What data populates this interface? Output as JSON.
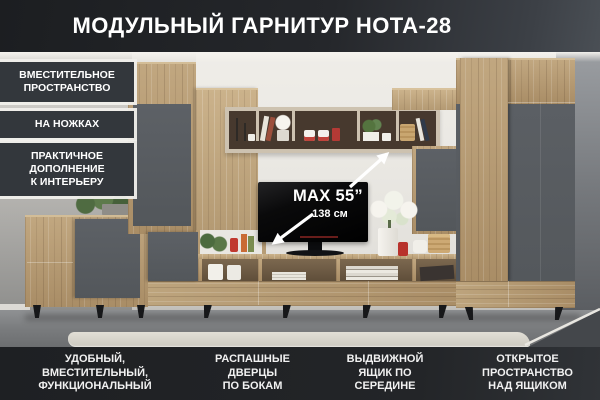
{
  "title": "МОДУЛЬНЫЙ ГАРНИТУР НОТА-28",
  "badges": [
    {
      "label": "ВМЕСТИТЕЛЬНОЕ\nПРОСТРАНСТВО"
    },
    {
      "label": "НА НОЖКАХ"
    },
    {
      "label": "ПРАКТИЧНОЕ\nДОПОЛНЕНИЕ\nК ИНТЕРЬЕРУ"
    }
  ],
  "tv": {
    "max_size": "MAX 55”",
    "diagonal": "138 см"
  },
  "features": [
    {
      "label": "УДОБНЫЙ,\nВМЕСТИТЕЛЬНЫЙ,\nФУНКЦИОНАЛЬНЫЙ"
    },
    {
      "label": "РАСПАШНЫЕ\nДВЕРЦЫ\nПО БОКАМ"
    },
    {
      "label": "ВЫДВИЖНОЙ\nЯЩИК ПО\nСЕРЕДИНЕ"
    },
    {
      "label": "ОТКРЫТОЕ\nПРОСТРАНСТВО\nНАД ЯЩИКОМ"
    }
  ],
  "colors": {
    "header_bg": "#25272b",
    "badge_bg": "#33373c",
    "bottom_bar_bg": "#202225",
    "wood": "#b2966f",
    "panel_gray": "#575b60",
    "text_light": "#ffffff"
  }
}
